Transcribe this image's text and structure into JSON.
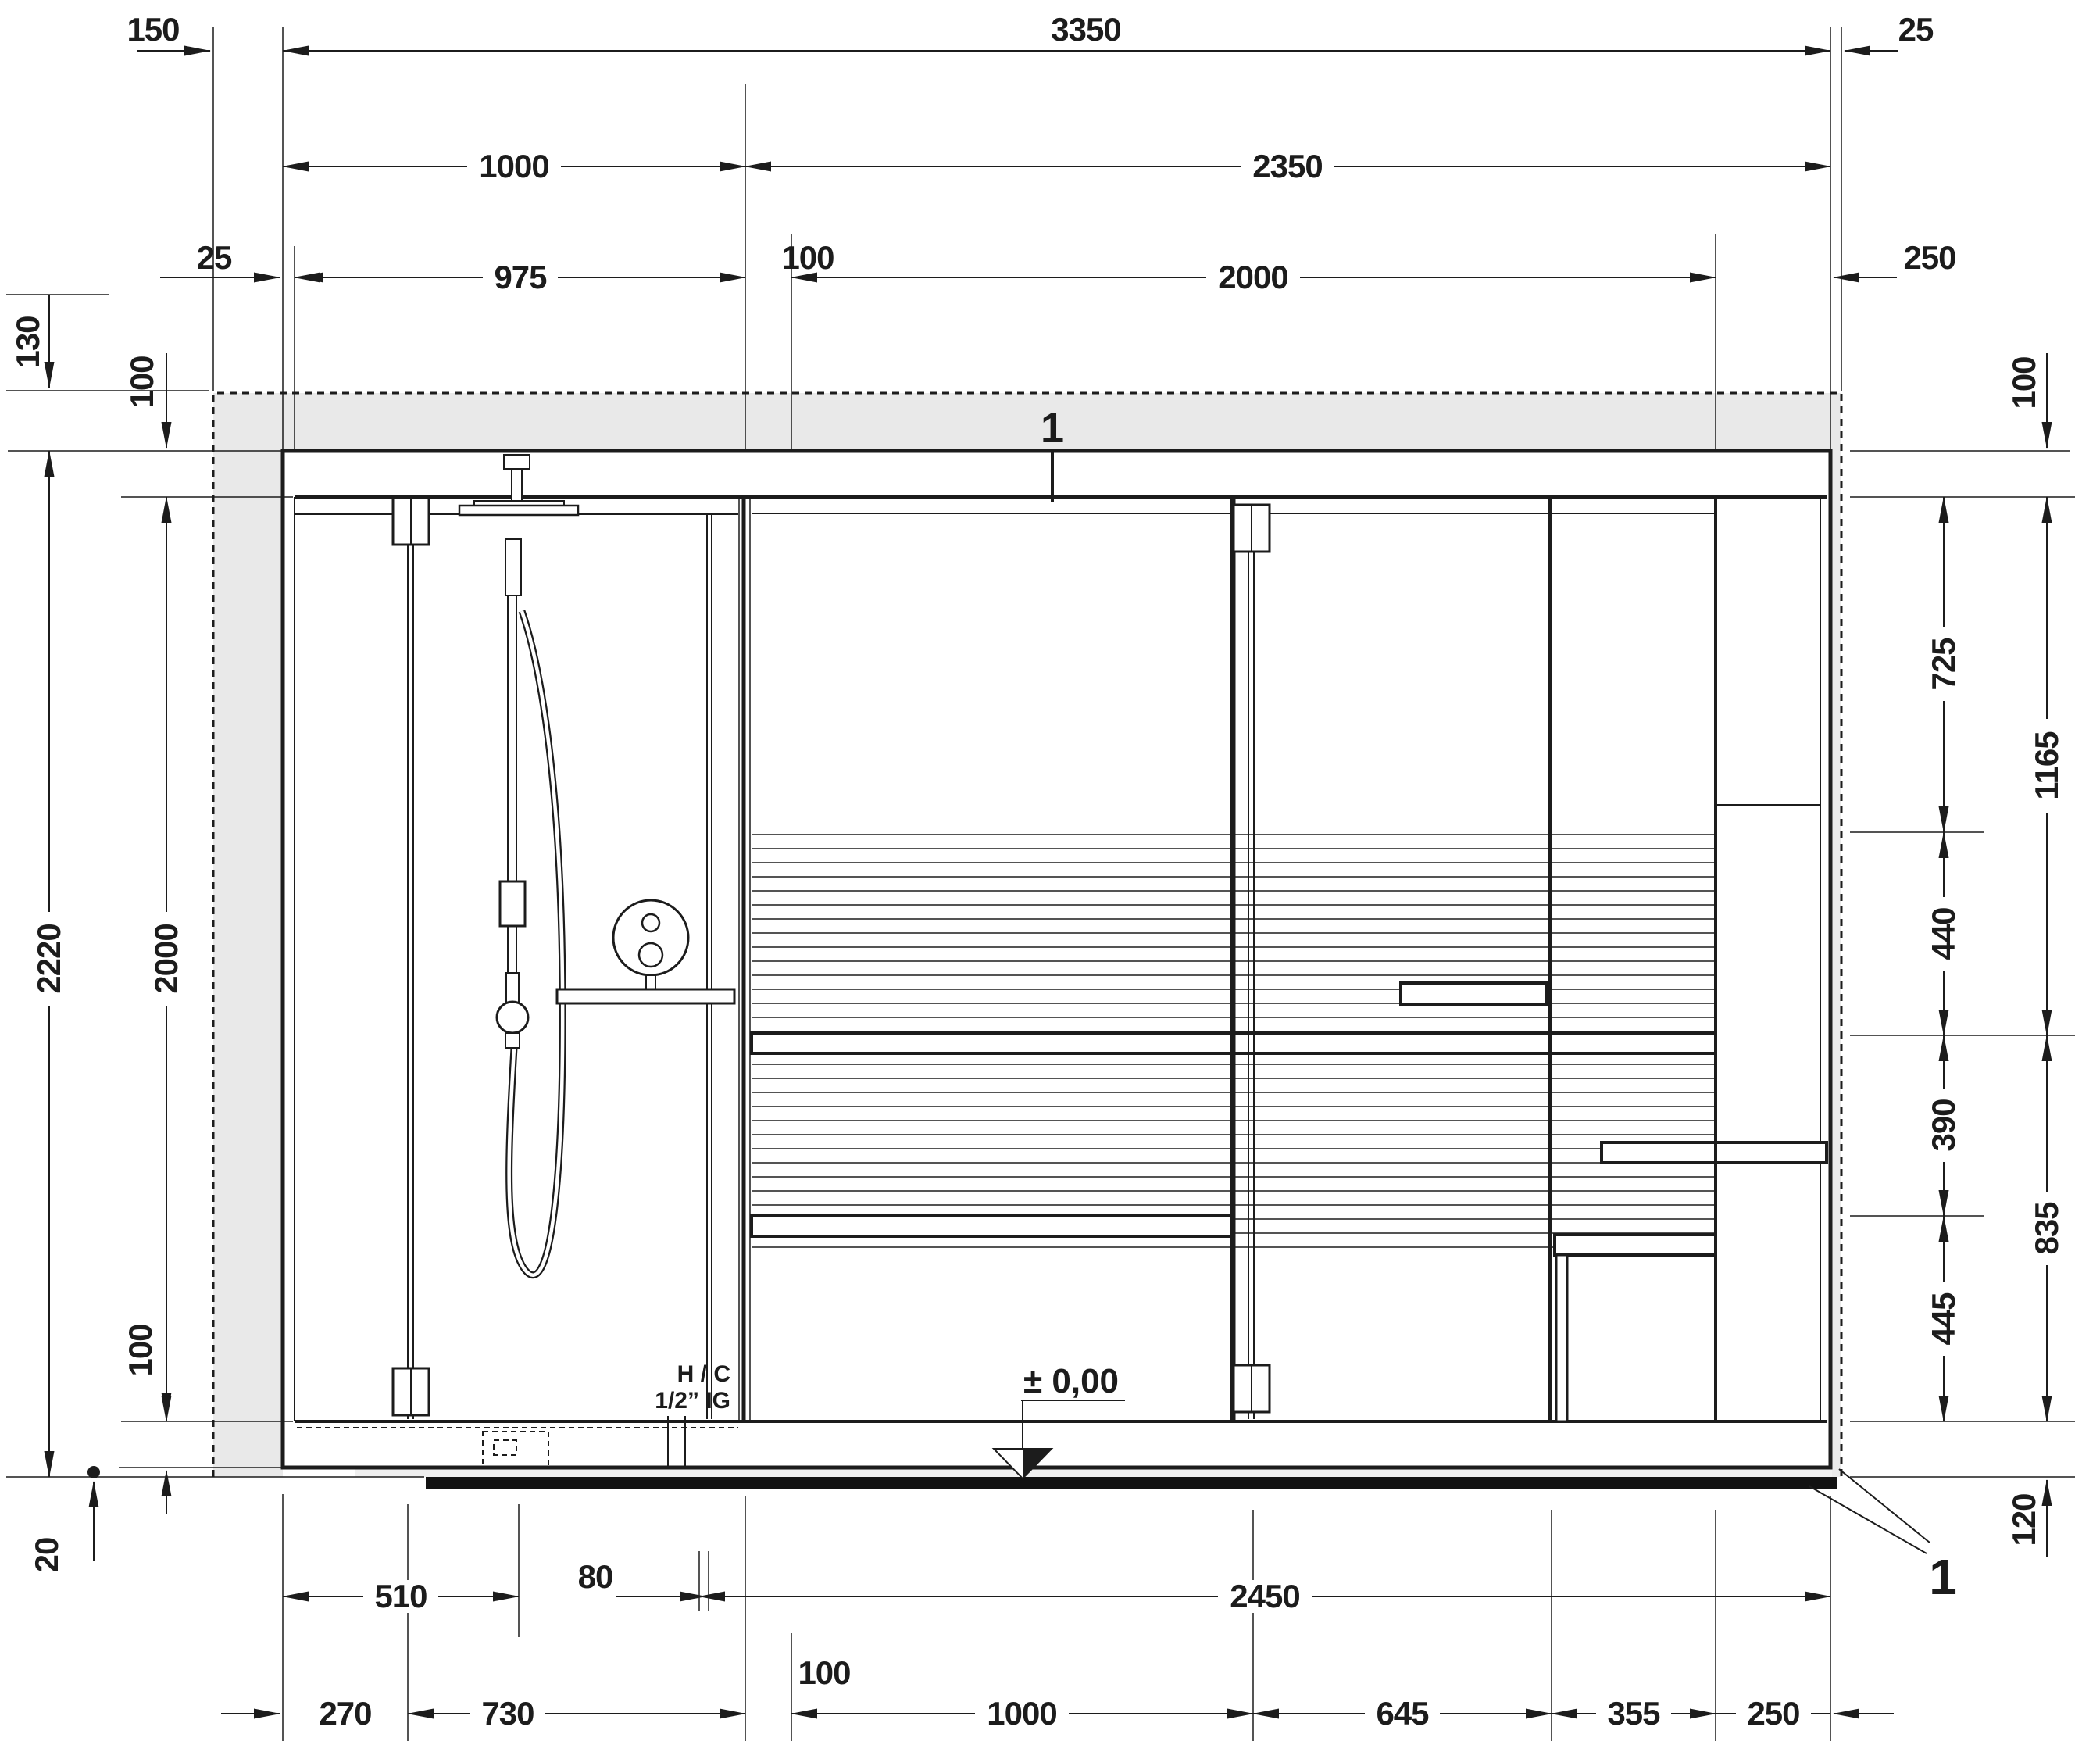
{
  "meta": {
    "type": "technical-elevation-drawing",
    "subject": "shower and sauna combination unit, front view with dimensions"
  },
  "colors": {
    "line": "#1c1c1c",
    "wall_fill": "#e9e9e9",
    "floor_slab": "#121212",
    "base_strip": "#efefef"
  },
  "labels": {
    "section_top": "1",
    "section_bottom": "1",
    "level_marker": "± 0,00",
    "supply_line1": "H / C",
    "supply_line2": "1/2” IG"
  },
  "dims": {
    "top_150": "150",
    "top_3350": "3350",
    "top_25_right": "25",
    "mid_1000": "1000",
    "mid_2350": "2350",
    "row3_25": "25",
    "row3_975": "975",
    "row3_100": "100",
    "row3_2000": "2000",
    "row3_250": "250",
    "left_130": "130",
    "left_100_top": "100",
    "left_2220": "2220",
    "left_2000": "2000",
    "left_100_bottom": "100",
    "left_20": "20",
    "right_100": "100",
    "right_725": "725",
    "right_1165": "1165",
    "right_440": "440",
    "right_390": "390",
    "right_835": "835",
    "right_445": "445",
    "right_120": "120",
    "b1_510": "510",
    "b1_80": "80",
    "b1_2450": "2450",
    "b2_270": "270",
    "b2_730": "730",
    "b2_100": "100",
    "b2_1000": "1000",
    "b2_645": "645",
    "b2_355": "355",
    "b2_250": "250"
  },
  "dimensions_mm": {
    "overall_width": 3350,
    "overall_height": 2220,
    "interior_height": 2000,
    "shower_section_width": 1000,
    "sauna_section_width": 2350,
    "top_row_values": [
      150,
      3350,
      25,
      1000,
      2350,
      25,
      975,
      100,
      2000,
      250
    ],
    "left_values": [
      130,
      100,
      2220,
      2000,
      100,
      20
    ],
    "right_values": [
      100,
      725,
      1165,
      440,
      390,
      835,
      445,
      120
    ],
    "bottom_values": [
      510,
      80,
      2450,
      270,
      730,
      100,
      1000,
      645,
      355,
      250
    ]
  }
}
